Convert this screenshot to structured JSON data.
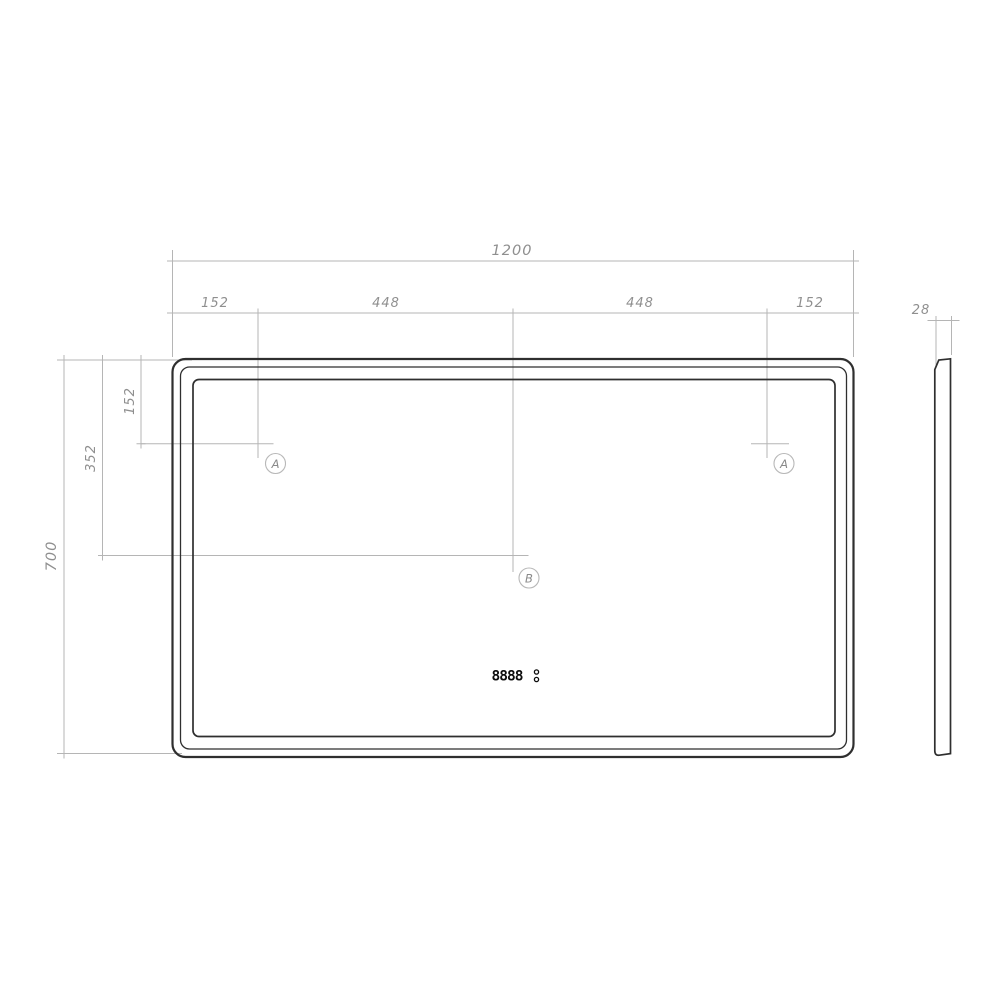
{
  "drawing": {
    "front_view": {
      "overall_width_label": "1200",
      "top_segment_labels": [
        "152",
        "448",
        "448",
        "152"
      ],
      "overall_height_label": "700",
      "left_segment_labels": [
        "152",
        "352"
      ],
      "markers": {
        "left": "A",
        "right": "A",
        "center": "B"
      },
      "display_digits": "8888"
    },
    "side_view": {
      "thickness_label": "28"
    },
    "colors": {
      "outline": "#2f2f2f",
      "dimension_lines": "#b5b5b5",
      "dimension_text": "#8f8f8f",
      "display": "#0d0d0d",
      "background": "#ffffff"
    }
  }
}
